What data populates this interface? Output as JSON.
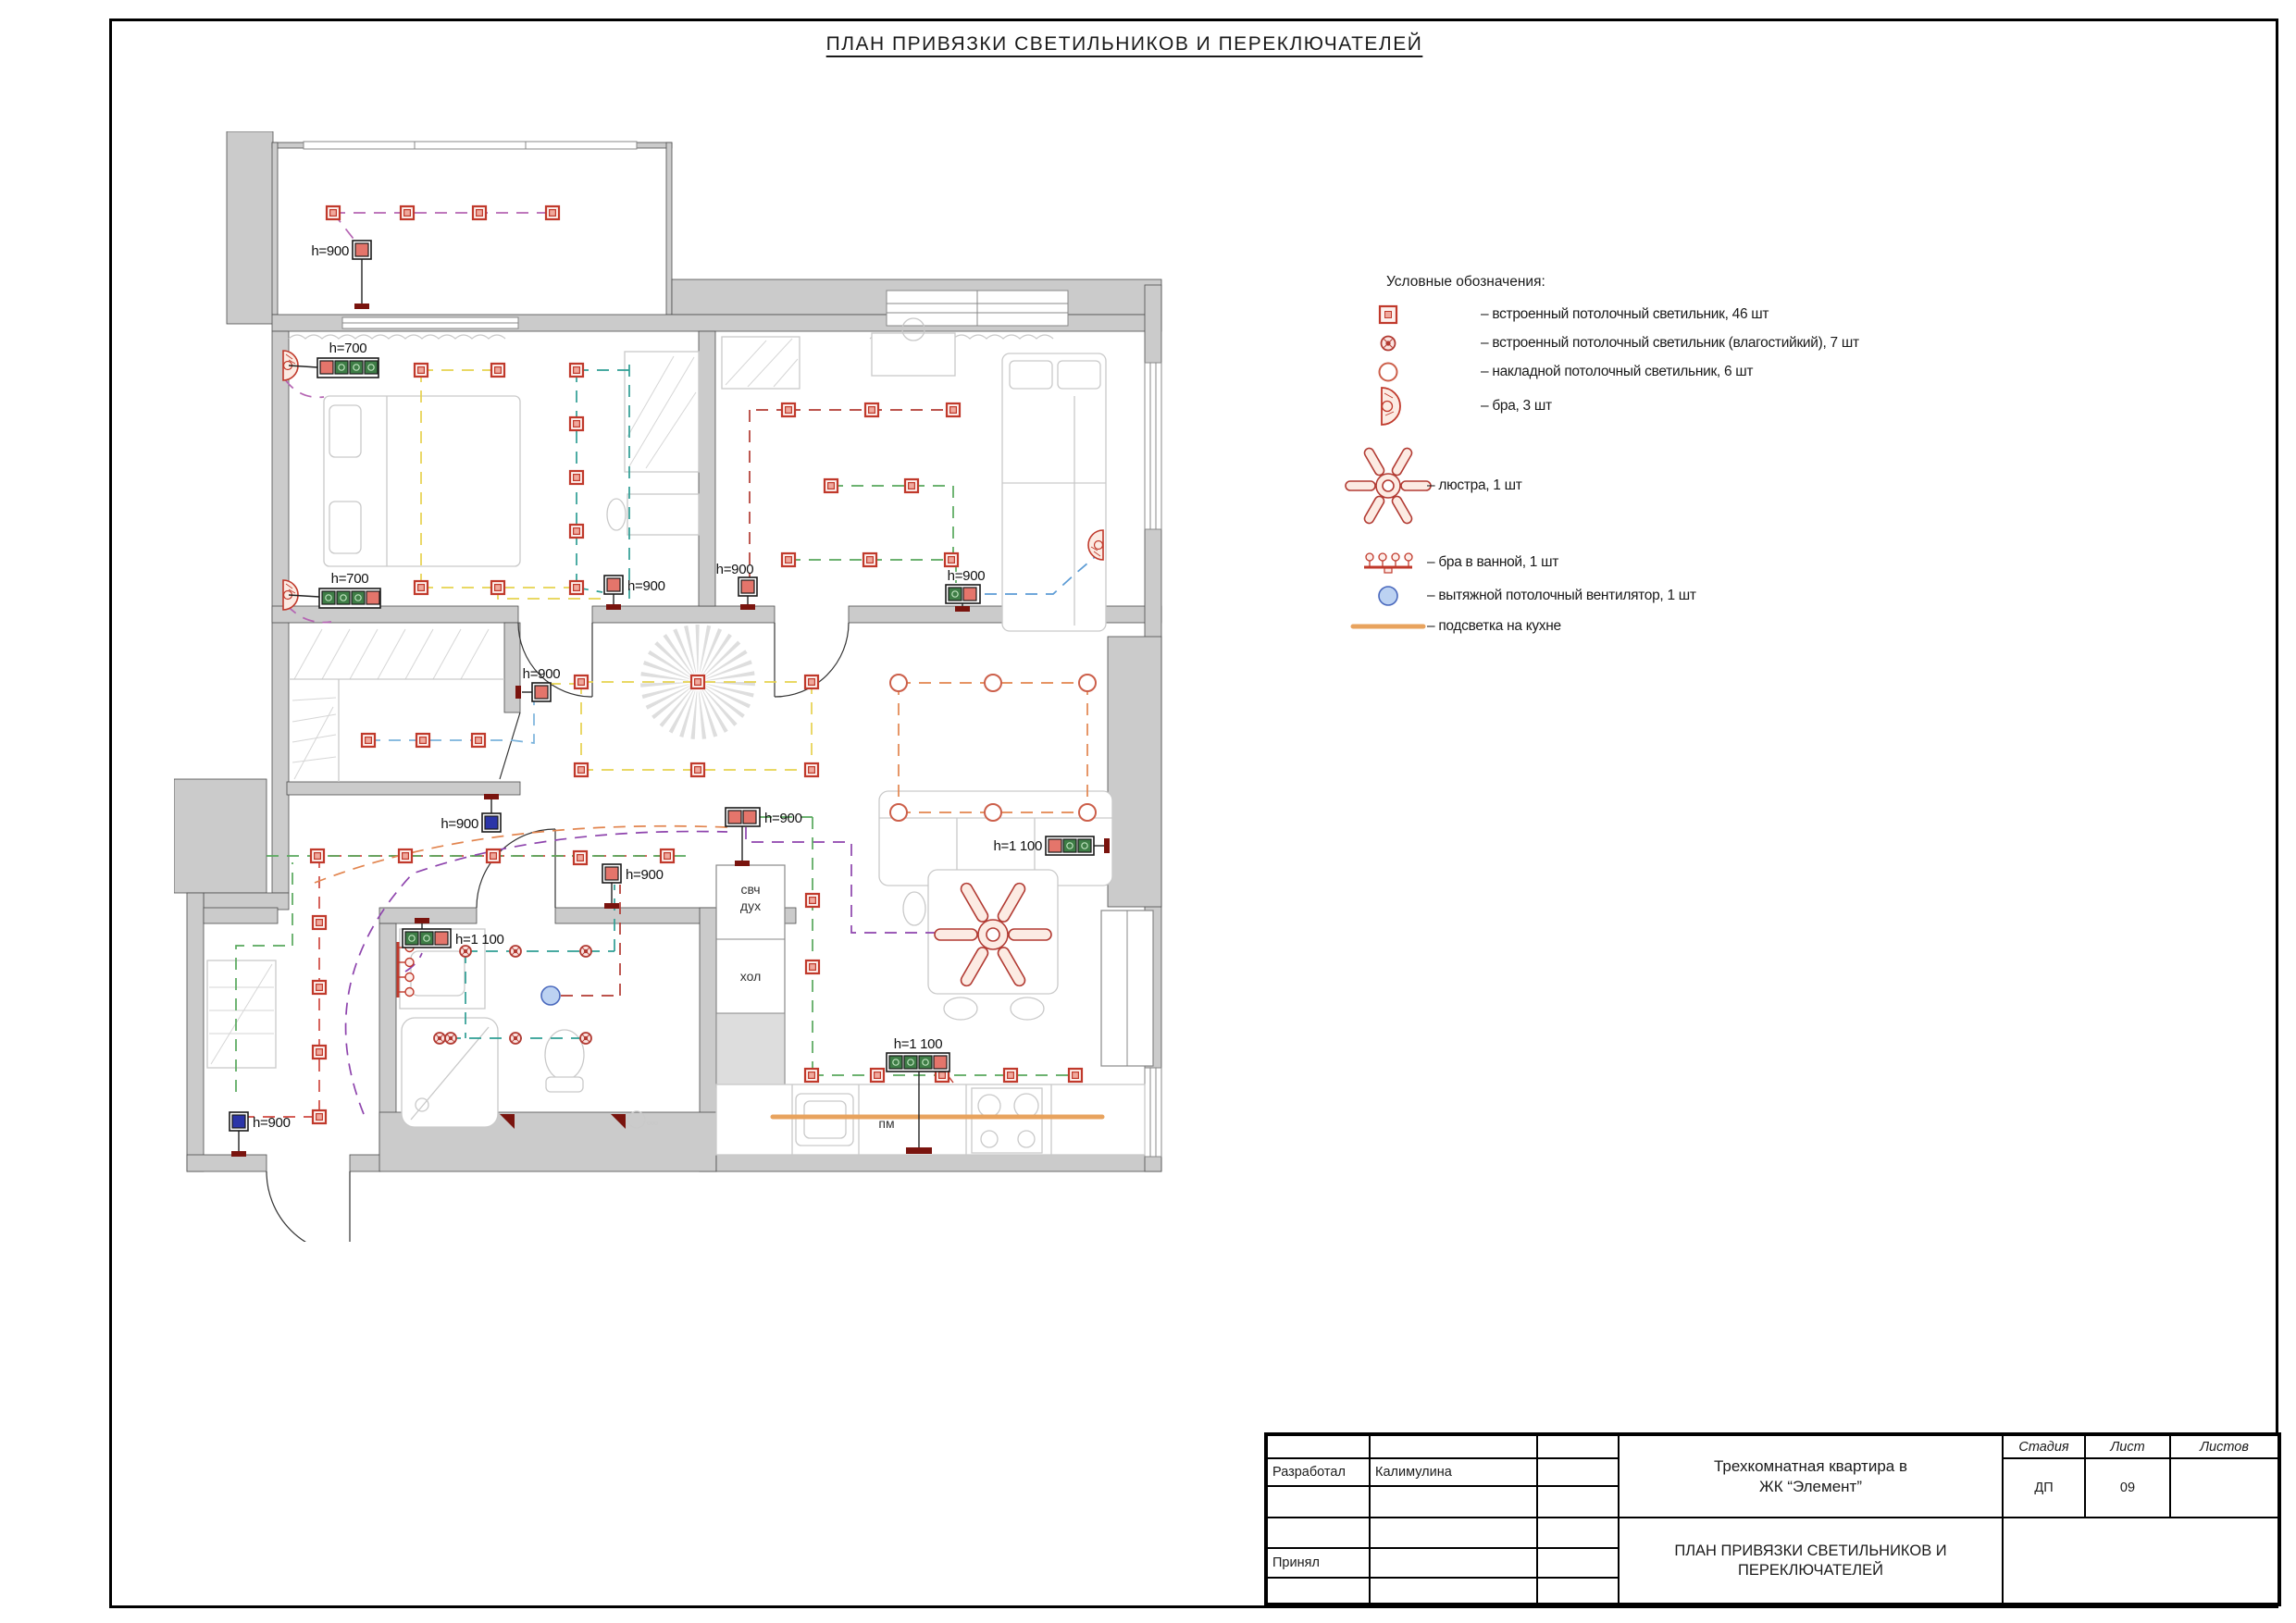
{
  "page": {
    "title": "ПЛАН ПРИВЯЗКИ СВЕТИЛЬНИКОВ И ПЕРЕКЛЮЧАТЕЛЕЙ"
  },
  "legend": {
    "title": "Условные обозначения:",
    "items": [
      {
        "icon": "recessed-ceiling-light-icon",
        "label": "– встроенный потолочный светильник, 46 шт"
      },
      {
        "icon": "recessed-ceiling-light-wet-icon",
        "label": "– встроенный потолочный светильник (влагостийкий), 7 шт"
      },
      {
        "icon": "surface-ceiling-light-icon",
        "label": "– накладной потолочный светильник, 6 шт"
      },
      {
        "icon": "sconce-icon",
        "label": "– бра, 3 шт"
      },
      {
        "icon": "chandelier-icon",
        "label": "– люстра, 1 шт"
      },
      {
        "icon": "bathroom-sconce-icon",
        "label": "– бра в ванной, 1 шт"
      },
      {
        "icon": "exhaust-fan-icon",
        "label": "– вытяжной потолочный вентилятор, 1 шт"
      },
      {
        "icon": "kitchen-led-strip-icon",
        "label": "– подсветка на кухне"
      }
    ],
    "colors": {
      "symbol_red": "#c0392b",
      "fan_blue": "#4a69bd",
      "strip_orange": "#e8a35e"
    }
  },
  "plan": {
    "h700": "h=700",
    "h900": "h=900",
    "h1100": "h=1 100",
    "labels": {
      "microwave": "свч",
      "oven": "дух",
      "fridge": "хол",
      "dishwasher": "пм"
    }
  },
  "title_block": {
    "developed_label": "Разработал",
    "developed_value": "Калимулина",
    "accepted_label": "Принял",
    "project_name": "Трехкомнатная квартира в\nЖК “Элемент”",
    "sheet_name": "ПЛАН ПРИВЯЗКИ СВЕТИЛЬНИКОВ И\nПЕРЕКЛЮЧАТЕЛЕЙ",
    "stage_label": "Стадия",
    "sheet_label": "Лист",
    "sheets_label": "Листов",
    "stage_value": "ДП",
    "sheet_value": "09",
    "sheets_value": ""
  }
}
